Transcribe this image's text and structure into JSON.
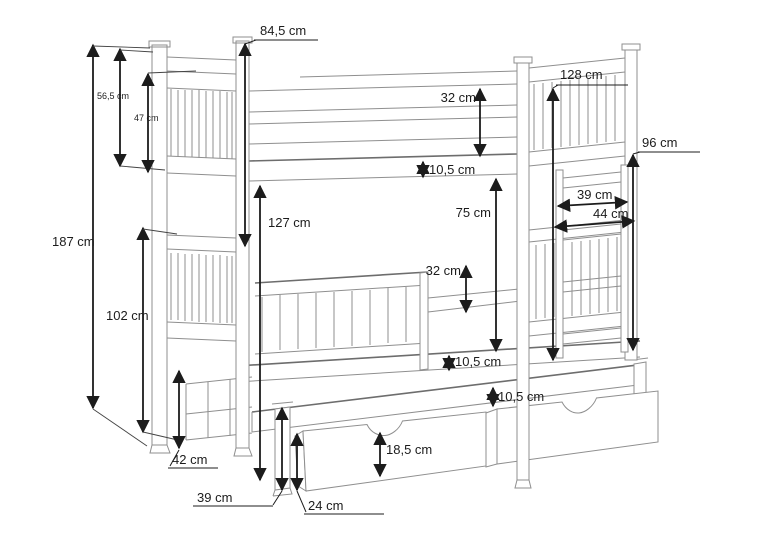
{
  "drawing": {
    "type": "furniture-technical-drawing",
    "subject": "Triple bunk bed with trundle and two storage drawers",
    "unit": "cm",
    "colors": {
      "background": "#ffffff",
      "structure_line": "#8f8f8f",
      "dimension_ink": "#1c1c1c"
    }
  },
  "dims": {
    "top_post_section": {
      "label": "84,5 cm",
      "value": 84.5
    },
    "total_height": {
      "label": "187 cm",
      "value": 187
    },
    "upper_headboard": {
      "label": "56,5 cm",
      "value": 56.5
    },
    "upper_headboard_slats": {
      "label": "47 cm",
      "value": 47
    },
    "upper_guard_rail": {
      "label": "32 cm",
      "value": 32
    },
    "upper_base_thickness": {
      "label": "10,5 cm",
      "value": 10.5
    },
    "under_upper_bunk": {
      "label": "127 cm",
      "value": 127
    },
    "lower_section": {
      "label": "102 cm",
      "value": 102
    },
    "upper_to_trundle": {
      "label": "75 cm",
      "value": 75
    },
    "lower_guard_rail": {
      "label": "32 cm",
      "value": 32
    },
    "lower_base_thickness": {
      "label": "10,5 cm",
      "value": 10.5
    },
    "trundle_gap": {
      "label": "10,5 cm",
      "value": 10.5
    },
    "trundle_left_end": {
      "label": "42 cm",
      "value": 42
    },
    "trundle_post": {
      "label": "39 cm",
      "value": 39
    },
    "drawer_total": {
      "label": "24 cm",
      "value": 24
    },
    "drawer_front": {
      "label": "18,5 cm",
      "value": 18.5
    },
    "upper_bunk_rail_top": {
      "label": "128 cm",
      "value": 128
    },
    "right_lower_section": {
      "label": "96 cm",
      "value": 96
    },
    "ladder_inner_width": {
      "label": "39 cm",
      "value": 39
    },
    "ladder_outer_width": {
      "label": "44 cm",
      "value": 44
    }
  }
}
